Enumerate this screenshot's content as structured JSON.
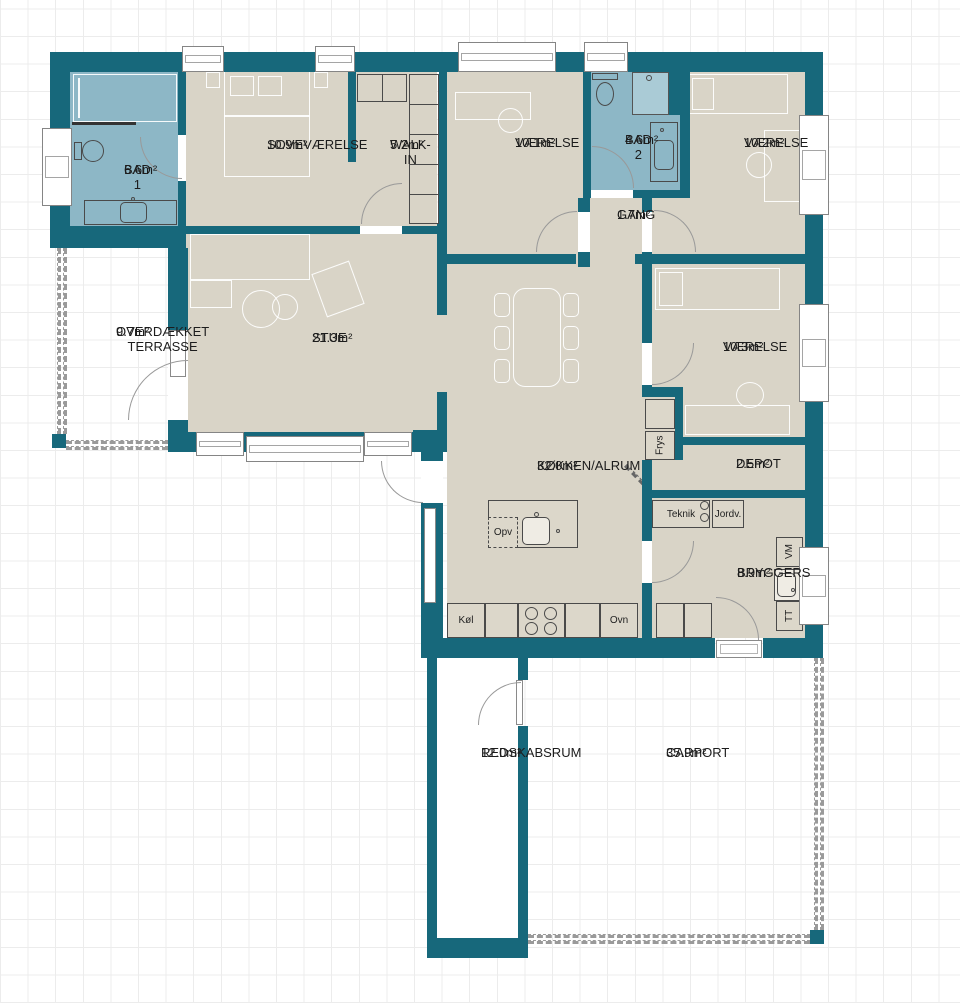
{
  "title": "Floor plan",
  "colors": {
    "wall": "#17687b",
    "floor": "#d9d4c7",
    "bath": "#8db7c6",
    "shower": "#aacbd6",
    "counter": "#dcd7ca"
  },
  "rooms": [
    {
      "id": "bad1",
      "name": "BAD 1",
      "area": "6.6m²"
    },
    {
      "id": "sovevaerelse",
      "name": "SOVEVÆRELSE",
      "area": "10.9m²"
    },
    {
      "id": "walkin",
      "name": "WALK-IN",
      "area": "5.2m²"
    },
    {
      "id": "vaerelse1",
      "name": "VÆRELSE",
      "area": "10.1m²"
    },
    {
      "id": "bad2",
      "name": "BAD 2",
      "area": "4.6m²"
    },
    {
      "id": "vaerelse2",
      "name": "VÆRELSE",
      "area": "10.2m²"
    },
    {
      "id": "gang",
      "name": "GANG",
      "area": "1.7m²"
    },
    {
      "id": "stue",
      "name": "STUE",
      "area": "21.3m²"
    },
    {
      "id": "terrasse",
      "name": "OVERDÆKKET\nTERRASSE",
      "area": "9.7m²"
    },
    {
      "id": "kokken",
      "name": "KØKKEN/ALRUM",
      "area": "32.0m²"
    },
    {
      "id": "vaerelse3",
      "name": "VÆRELSE",
      "area": "10.3m²"
    },
    {
      "id": "depot",
      "name": "DEPOT",
      "area": "2.5m²"
    },
    {
      "id": "bryggers",
      "name": "BRYGGERS",
      "area": "8.9m²"
    },
    {
      "id": "redskabsrum",
      "name": "REDSKABSRUM",
      "area": "12.0m²"
    },
    {
      "id": "carport",
      "name": "CARPORT",
      "area": "35.9m²"
    }
  ],
  "appliances": {
    "fridge": "Køl",
    "oven": "Ovn",
    "dishwasher": "Opv",
    "freezer": "Frys",
    "tech": "Teknik",
    "ground": "Jordv.",
    "washer": "VM",
    "dryer": "TT"
  }
}
